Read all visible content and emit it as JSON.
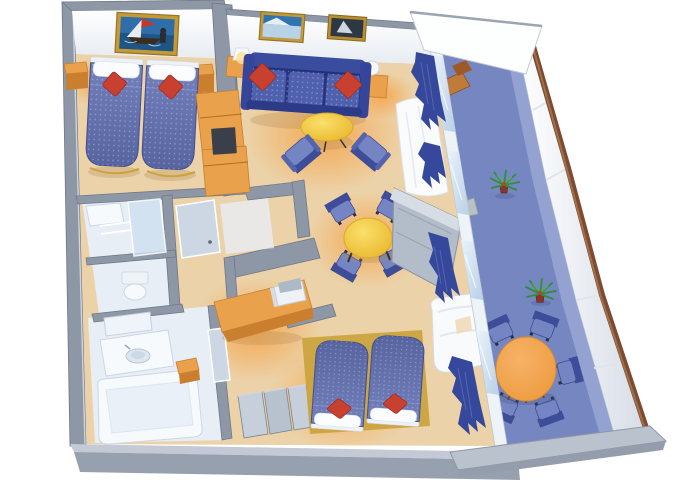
{
  "meta": {
    "title": "Cruise ship suite — isometric cutaway floor plan",
    "view": "3d-isometric-cutaway",
    "visible_text": "none"
  },
  "palette": {
    "wall": "#8d97a6",
    "wall-edge": "#6e7987",
    "wall-face": "#fbfcfd",
    "carpet": "#ecd2a8",
    "carpet-glow": "#f29b3e",
    "bath-floor": "#e8eef5",
    "deck": "#7586c1",
    "deck-light": "#9dabd6",
    "balcony-wall": "#f3f6fa",
    "rail": "#7c4b31",
    "wood": "#e9a24b",
    "wood-dark": "#c97f2e",
    "bed-blue": "#6673b2",
    "bed-dark": "#49579e",
    "sofa-blue": "#4f61ae",
    "sofa-dark": "#2c3a87",
    "pillow-red": "#c8402f",
    "table-yellow": "#f6d23f",
    "table-orange": "#f2a44e",
    "chair-blue": "#7585c3",
    "chair-dark": "#3e4d97",
    "glass": "#cfe0f0",
    "fixture-white": "#f7fafc",
    "frame-gold": "#c59a36",
    "curtain-blue": "#36489c",
    "plant-green": "#2f8f3a",
    "plant-pot": "#8a3328"
  },
  "rooms": [
    {
      "id": "master-bedroom",
      "name": "Master bedroom",
      "furniture": [
        "twin bed",
        "twin bed",
        "white pillows",
        "red accent pillows",
        "nightstand",
        "nightstand",
        "framed sailing artwork",
        "wardrobe cabinet"
      ]
    },
    {
      "id": "living-room",
      "name": "Living room",
      "furniture": [
        "three-seat sofa",
        "red accent pillows",
        "round coffee table",
        "club armchair",
        "club armchair",
        "side table with lamp",
        "side table with sphere lamp",
        "framed seascape artwork",
        "framed ship artwork",
        "sheer curtain"
      ]
    },
    {
      "id": "dining-area",
      "name": "Dining area",
      "furniture": [
        "round dining table",
        "dining chair",
        "dining chair",
        "dining chair",
        "dining chair"
      ]
    },
    {
      "id": "office-nook",
      "name": "Writing desk nook",
      "furniture": [
        "writing desk",
        "television",
        "stool"
      ]
    },
    {
      "id": "second-bedroom",
      "name": "Second bedroom",
      "furniture": [
        "joined twin beds",
        "red accent pillows",
        "closet units",
        "dresser cabinet",
        "white lounge chair",
        "blue curtains"
      ]
    },
    {
      "id": "bathroom",
      "name": "Bathroom",
      "furniture": [
        "bathtub",
        "vanity with round sink",
        "mirror"
      ]
    },
    {
      "id": "shower-room",
      "name": "Shower / WC rooms",
      "furniture": [
        "glass shower",
        "toilet"
      ]
    },
    {
      "id": "entry",
      "name": "Entry corridor",
      "furniture": [
        "entry door"
      ]
    },
    {
      "id": "balcony",
      "name": "Private balcony",
      "furniture": [
        "round outdoor table",
        "outdoor chair",
        "outdoor chair",
        "outdoor chair",
        "outdoor chair",
        "outdoor chair",
        "potted palm",
        "potted palm",
        "sun lounger",
        "privacy canopy",
        "railing"
      ]
    }
  ]
}
